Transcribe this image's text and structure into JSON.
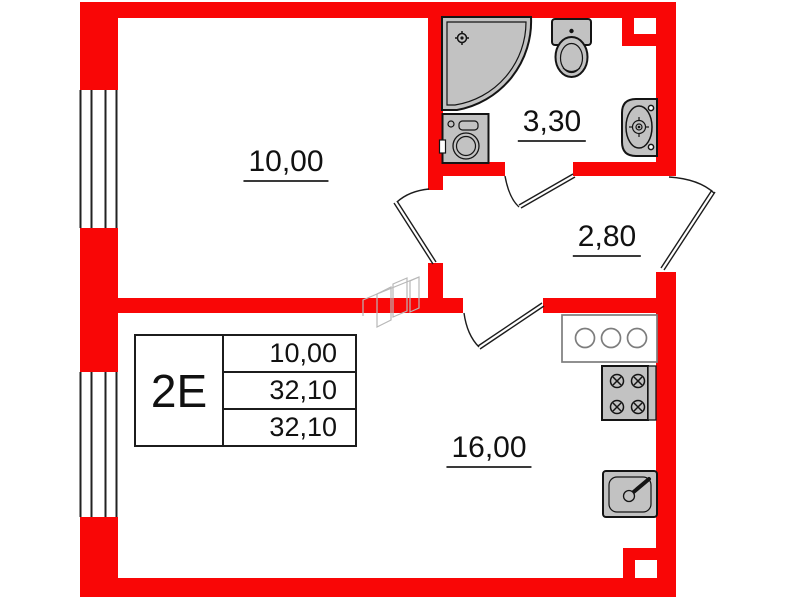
{
  "title": "Apartment floor plan",
  "unit_card": {
    "unit": "2E",
    "rows": [
      "10,00",
      "32,10",
      "32,10"
    ]
  },
  "room_labels": {
    "living_room": "10,00",
    "bathroom": "3,30",
    "hallway": "2,80",
    "kitchen_living": "16,00"
  },
  "fixtures": [
    "corner-shower",
    "shower-drain",
    "toilet",
    "wall-basin",
    "washing-machine",
    "kitchen-counter",
    "gas-stove",
    "kitchen-sink",
    "vent-shaft-top",
    "vent-shaft-bottom",
    "window",
    "door-swing",
    "ghost-furniture"
  ],
  "colors": {
    "wall_red": "#f90606",
    "fixture_gray": "#c2c2c2",
    "outline": "#141414",
    "ghost_gray": "#b8b8b8",
    "counter_gray": "#7d7d7d"
  }
}
